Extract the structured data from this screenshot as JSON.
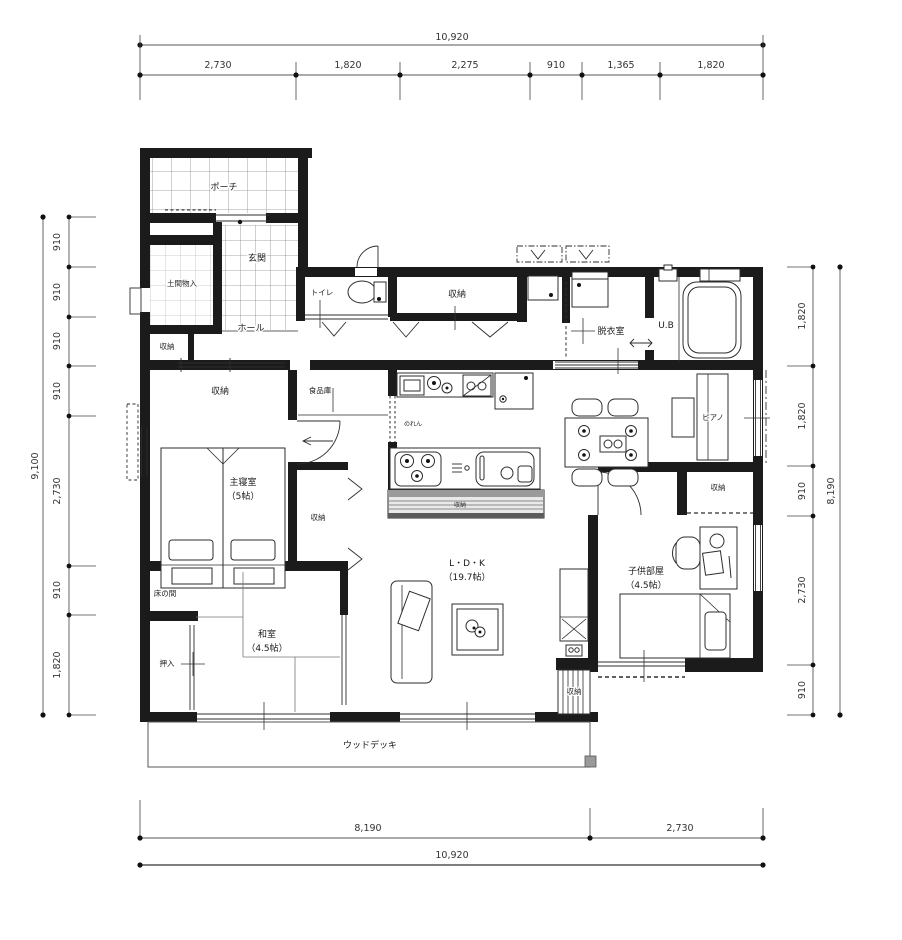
{
  "dims": {
    "top": {
      "total": "10,920",
      "segments": [
        "2,730",
        "1,820",
        "2,275",
        "910",
        "1,365",
        "1,820"
      ]
    },
    "left": {
      "total": "9,100",
      "segments": [
        "910",
        "910",
        "910",
        "910",
        "2,730",
        "910",
        "1,820"
      ]
    },
    "right": {
      "total": "8,190",
      "segments": [
        "1,820",
        "1,820",
        "910",
        "2,730",
        "910"
      ]
    },
    "bottom": {
      "total": "10,920",
      "segments": [
        "8,190",
        "2,730"
      ]
    }
  },
  "rooms": {
    "porch": "ポーチ",
    "genkan": "玄関",
    "doma_storage": "土間物入",
    "entry_storage": "収納",
    "hall": "ホール",
    "toilet": "トイレ",
    "hall_storage": "収納",
    "dressing_room": "脱衣室",
    "unit_bath": "U.B",
    "pantry": "食品庫",
    "bedroom_storage": "収納",
    "master_bedroom": "主寝室",
    "master_bedroom_size": "（5帖）",
    "bedroom_closet": "収納",
    "tokonoma": "床の間",
    "oshiire": "押入",
    "washitsu": "和室",
    "washitsu_size": "（4.5帖）",
    "ldk": "L・D・K",
    "ldk_size": "（19.7帖）",
    "noren": "のれん",
    "counter_storage": "収納",
    "piano": "ピアノ",
    "kids_storage": "収納",
    "kids_room": "子供部屋",
    "kids_room_size": "（4.5帖）",
    "ldk_storage": "収納",
    "wood_deck": "ウッドデッキ"
  }
}
